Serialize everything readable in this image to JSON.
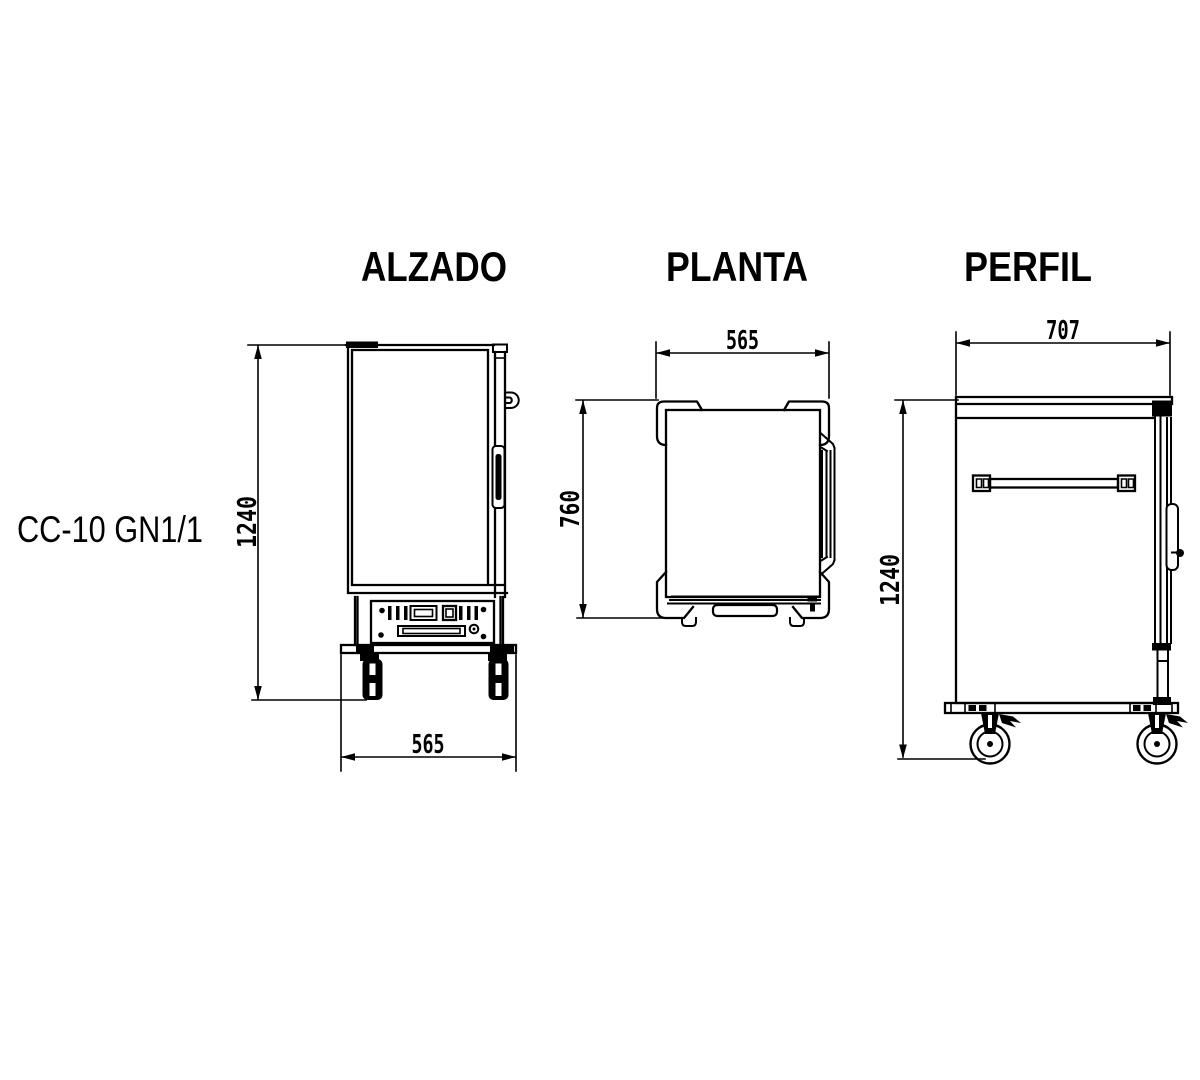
{
  "page": {
    "background": "#ffffff",
    "line_color": "#000000"
  },
  "model_label": "CC-10 GN1/1",
  "views": {
    "alzado": {
      "title": "ALZADO",
      "dimensions": {
        "height": "1240",
        "width": "565"
      }
    },
    "planta": {
      "title": "PLANTA",
      "dimensions": {
        "width": "565",
        "depth": "760"
      }
    },
    "perfil": {
      "title": "PERFIL",
      "dimensions": {
        "width": "707",
        "height": "1240"
      }
    }
  }
}
